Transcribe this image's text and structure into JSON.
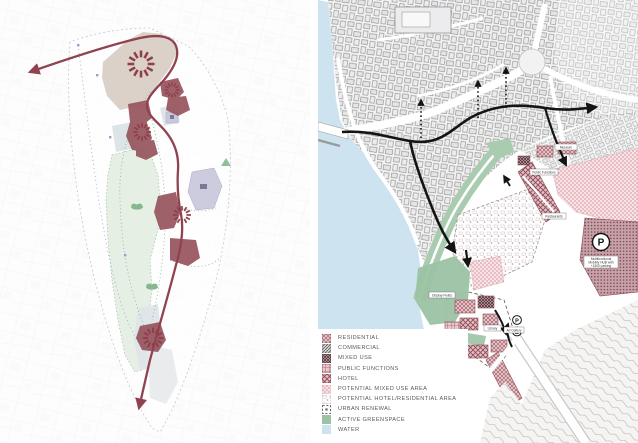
{
  "legend": {
    "items": [
      {
        "label": "RESIDENTIAL",
        "swatch": "residential"
      },
      {
        "label": "COMMERCIAL",
        "swatch": "commercial"
      },
      {
        "label": "MIXED USE",
        "swatch": "mixed-use"
      },
      {
        "label": "PUBLIC FUNCTIONS",
        "swatch": "public-functions"
      },
      {
        "label": "HOTEL",
        "swatch": "hotel"
      },
      {
        "label": "POTENTIAL MIXED USE AREA",
        "swatch": "potential-mixed-use"
      },
      {
        "label": "POTENTIAL HOTEL/RESIDENTIAL AREA",
        "swatch": "potential-hotel-residential"
      },
      {
        "label": "URBAN RENEWAL",
        "swatch": "urban-renewal"
      },
      {
        "label": "ACTIVE GREENSPACE",
        "swatch": "active-greenspace"
      },
      {
        "label": "WATER",
        "swatch": "water"
      }
    ]
  },
  "right_map": {
    "labels": {
      "museum": "Museum",
      "public_functions": "Public Functions",
      "restaurants": "Restaurants",
      "display_fields": "Display Fields",
      "family_hotel": "Family Hotel",
      "library": "Library",
      "gallery": "Art Gallery",
      "future_dev1": "Potential Future",
      "future_dev2": "Development",
      "hub_line1": "Multifunctional",
      "hub_line2": "Mobility HUB with",
      "hub_line3": "+1500 parking"
    },
    "markers": {
      "parking_badge": "P",
      "parking_small": "P",
      "bus_small": "B"
    }
  },
  "colors": {
    "route_maroon": "#8f4350",
    "route_black": "#141414",
    "water": "#cde4f0",
    "greenspace": "#9cc2a4",
    "green_strip": "#a9cbb0",
    "beige_area": "#d9cfc5",
    "pink_fill": "#e7c9cd",
    "lavender": "#cdccde"
  }
}
